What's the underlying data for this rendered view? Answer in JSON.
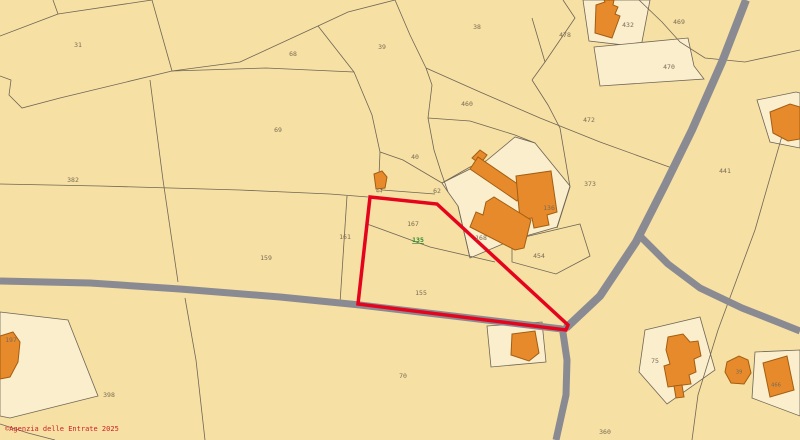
{
  "map": {
    "colors": {
      "background": "#F6E0A4",
      "urban_parcel_fill": "#FAEECD",
      "boundary_line": "#6E6656",
      "road": "#8A8A92",
      "building_fill": "#E78A2B",
      "building_stroke": "#A35E12",
      "highlight_stroke": "#E4041E",
      "label_color": "#7A6B54",
      "selected_label_color": "#2E8B2E",
      "copyright_color": "#D01F26"
    },
    "boundaries": [
      "53,0 58,14 0,36",
      "58,14 152,0",
      "152,0 161,32 172,71",
      "0,76 11,80 9,95 22,108 60,98 172,71",
      "172,71 240,62 318,26 348,12 395,0",
      "172,71 266,68 354,72",
      "318,26 354,72",
      "354,72 372,115 380,152 379,176 382,190",
      "395,0 410,35 426,68",
      "426,68 432,85 428,118 434,150 441,172 448,192",
      "426,68 480,92 540,118 600,142 672,168",
      "150,80 163,180 178,282",
      "0,184 100,186 240,190 330,194 368,197",
      "347,196 340,303",
      "380,152 403,160 442,183",
      "382,190 435,194",
      "442,183 470,167 486,161",
      "367,224 430,247 495,262",
      "458,206 470,258",
      "185,298 196,360 205,440",
      "563,0 575,18 545,62 532,80",
      "532,18 545,62",
      "532,80 548,105 560,128",
      "639,0 662,22 680,42 705,58 745,62 800,50",
      "560,128 570,187 557,228",
      "512,240 580,224 590,256 556,274 512,262 512,240",
      "790,108 755,230 718,330 698,395 692,440",
      "0,424 28,433 55,440",
      "428,118 470,121 515,135 535,143"
    ],
    "urban_parcels": [
      "583,0 650,0 641,47 589,41",
      "442,183 486,161 515,137 535,143 570,186 557,227 512,240 470,258 458,206 448,192",
      "645,330 700,317 715,370 667,404 639,372",
      "755,352 800,350 800,416 752,398",
      "0,312 68,320 98,396 10,418 0,416",
      "487,326 542,322 546,362 491,367",
      "594,47 688,38 694,66 704,79 600,86",
      "757,100 796,92 800,93 800,148 770,142"
    ],
    "roads": [
      {
        "points": "0,281 90,283 180,289 280,297 360,305 470,318 562,329",
        "width": 7
      },
      {
        "points": "746,0 722,62 692,130 665,185 636,242 600,296 566,328",
        "width": 8
      },
      {
        "points": "640,236 668,264 700,288 742,308 775,321 800,331",
        "width": 7
      },
      {
        "points": "562,326 567,360 566,395 556,440",
        "width": 7
      }
    ],
    "buildings": [
      "596,5 605,2 604,0 614,0 613,5 618,7 615,14 620,16 612,38 595,33",
      "374,174 382,171 387,177 385,188 376,189",
      "472,158 480,150 487,155 480,164",
      "470,169 478,157 525,189 517,201",
      "516,176 551,171 557,212 547,215 549,225 534,228 532,218 520,220",
      "486,202 494,197 531,220 524,248 515,250 470,227 476,212 483,215",
      "512,334 535,331 539,353 529,361 511,355",
      "0,336 13,332 20,342 18,362 10,377 0,379",
      "668,337 683,334 690,342 698,341 701,356 694,359 696,372 689,375 691,384 668,387 664,366 670,364 666,350",
      "674,386 682,385 684,397 676,398",
      "727,362 739,356 748,360 751,373 744,384 731,383 725,372",
      "763,363 787,356 794,390 770,397",
      "770,112 790,104 800,107 800,139 788,141 773,133"
    ],
    "highlight_parcel": {
      "parcel_number": "135",
      "points": "370,197 437,204 568,325 566,330 358,304",
      "stroke_width": 3.5
    },
    "labels": [
      {
        "text": "31",
        "x": 78,
        "y": 45
      },
      {
        "text": "68",
        "x": 293,
        "y": 54
      },
      {
        "text": "39",
        "x": 382,
        "y": 47
      },
      {
        "text": "38",
        "x": 477,
        "y": 27
      },
      {
        "text": "478",
        "x": 565,
        "y": 35
      },
      {
        "text": "432",
        "x": 628,
        "y": 25
      },
      {
        "text": "469",
        "x": 679,
        "y": 22
      },
      {
        "text": "470",
        "x": 669,
        "y": 67
      },
      {
        "text": "460",
        "x": 467,
        "y": 104
      },
      {
        "text": "472",
        "x": 589,
        "y": 120
      },
      {
        "text": "69",
        "x": 278,
        "y": 130
      },
      {
        "text": "382",
        "x": 73,
        "y": 180
      },
      {
        "text": "40",
        "x": 415,
        "y": 157
      },
      {
        "text": "44",
        "x": 379,
        "y": 191,
        "small": true
      },
      {
        "text": "62",
        "x": 437,
        "y": 191
      },
      {
        "text": "373",
        "x": 590,
        "y": 184
      },
      {
        "text": "136",
        "x": 549,
        "y": 208
      },
      {
        "text": "441",
        "x": 725,
        "y": 171
      },
      {
        "text": "167",
        "x": 413,
        "y": 224
      },
      {
        "text": "135",
        "x": 418,
        "y": 240,
        "selected": true
      },
      {
        "text": "168",
        "x": 481,
        "y": 238
      },
      {
        "text": "454",
        "x": 539,
        "y": 256
      },
      {
        "text": "161",
        "x": 345,
        "y": 237
      },
      {
        "text": "159",
        "x": 266,
        "y": 258
      },
      {
        "text": "155",
        "x": 421,
        "y": 293
      },
      {
        "text": "197",
        "x": 11,
        "y": 340
      },
      {
        "text": "398",
        "x": 109,
        "y": 395
      },
      {
        "text": "70",
        "x": 403,
        "y": 376
      },
      {
        "text": "75",
        "x": 655,
        "y": 361
      },
      {
        "text": "360",
        "x": 605,
        "y": 432
      },
      {
        "text": "39",
        "x": 739,
        "y": 372,
        "small": true
      },
      {
        "text": "466",
        "x": 776,
        "y": 385,
        "small": true
      }
    ]
  },
  "footer": {
    "copyright": "©Agenzia delle Entrate 2025"
  }
}
